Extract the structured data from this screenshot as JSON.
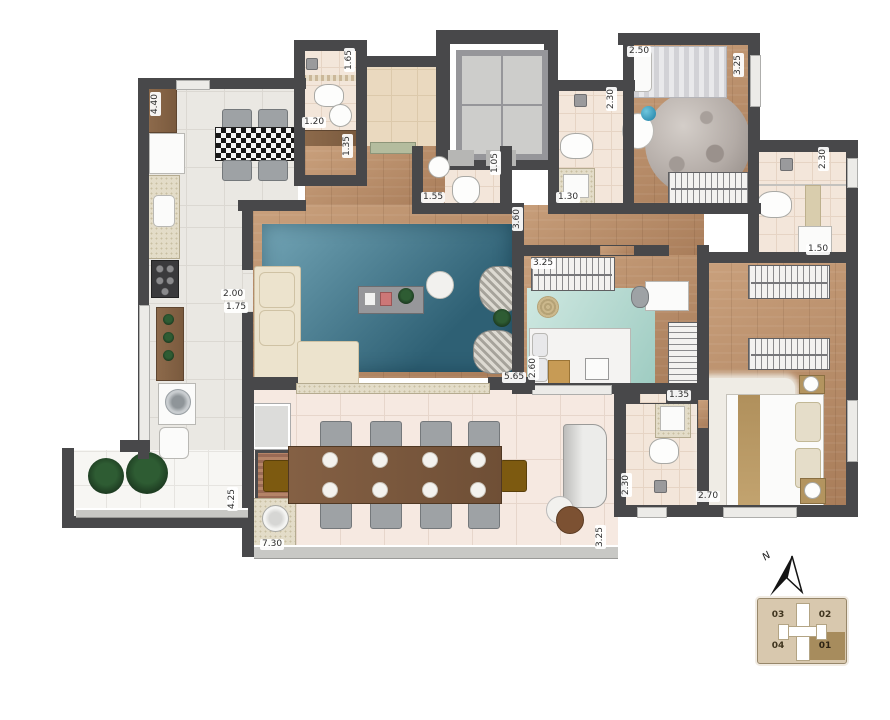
{
  "title": "Apartment floor plan",
  "compass": {
    "label": "N"
  },
  "keyplan": {
    "units": [
      {
        "label": "03",
        "highlighted": false
      },
      {
        "label": "02",
        "highlighted": false
      },
      {
        "label": "04",
        "highlighted": false
      },
      {
        "label": "01",
        "highlighted": true
      }
    ]
  },
  "dimension_labels": [
    {
      "text": "4.40",
      "x": 150,
      "y": 92,
      "vertical": true
    },
    {
      "text": "1.65",
      "x": 344,
      "y": 48,
      "vertical": true
    },
    {
      "text": "1.20",
      "x": 302,
      "y": 117,
      "vertical": false
    },
    {
      "text": "1.35",
      "x": 342,
      "y": 134,
      "vertical": true
    },
    {
      "text": "2.50",
      "x": 627,
      "y": 46,
      "vertical": false
    },
    {
      "text": "3.25",
      "x": 733,
      "y": 53,
      "vertical": true
    },
    {
      "text": "2.30",
      "x": 606,
      "y": 87,
      "vertical": true
    },
    {
      "text": "1.05",
      "x": 490,
      "y": 151,
      "vertical": true
    },
    {
      "text": "1.55",
      "x": 421,
      "y": 192,
      "vertical": false
    },
    {
      "text": "1.30",
      "x": 556,
      "y": 192,
      "vertical": false
    },
    {
      "text": "3.60",
      "x": 512,
      "y": 207,
      "vertical": true
    },
    {
      "text": "2.30",
      "x": 818,
      "y": 147,
      "vertical": true
    },
    {
      "text": "1.50",
      "x": 806,
      "y": 244,
      "vertical": false
    },
    {
      "text": "2.00",
      "x": 221,
      "y": 289,
      "vertical": false
    },
    {
      "text": "1.75",
      "x": 224,
      "y": 302,
      "vertical": false
    },
    {
      "text": "3.25",
      "x": 531,
      "y": 258,
      "vertical": false
    },
    {
      "text": "2.60",
      "x": 528,
      "y": 356,
      "vertical": true
    },
    {
      "text": "5.65",
      "x": 502,
      "y": 372,
      "vertical": false
    },
    {
      "text": "1.35",
      "x": 667,
      "y": 390,
      "vertical": false
    },
    {
      "text": "2.30",
      "x": 621,
      "y": 473,
      "vertical": true
    },
    {
      "text": "2.70",
      "x": 696,
      "y": 491,
      "vertical": false
    },
    {
      "text": "4.25",
      "x": 227,
      "y": 487,
      "vertical": true
    },
    {
      "text": "7.30",
      "x": 260,
      "y": 539,
      "vertical": false
    },
    {
      "text": "3.25",
      "x": 595,
      "y": 525,
      "vertical": true
    }
  ],
  "palette": {
    "wall": "#48484a",
    "wood": "#b3895f",
    "kitchen_tile": "#eae8e3",
    "terrace_tile": "#f6e9e1",
    "balcony_tile": "#f7f6f3",
    "marble": "#ead9bf",
    "rug_blue": "#3f7089",
    "rug_teal": "#b7dcd4",
    "keyplan_beige": "#d8c8ae",
    "keyplan_highlight": "#a78c5d"
  }
}
